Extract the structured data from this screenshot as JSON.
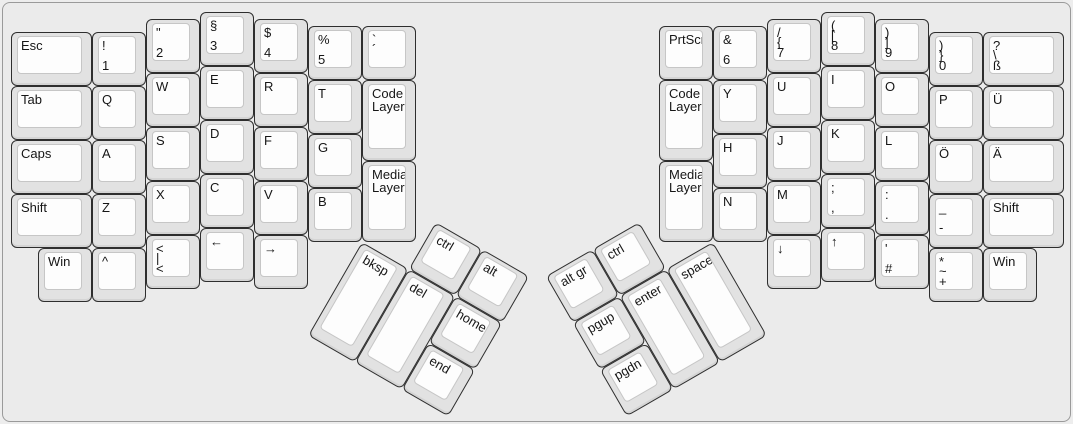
{
  "app": {
    "background_color": "#ebebeb",
    "panel_border_color": "#9a9a9a",
    "key_cap_color": "#e2e2e2",
    "key_top_color": "#fdfdfd",
    "key_border_color": "#2e2e2e",
    "label_color": "#161616"
  },
  "keyboard": {
    "unit": 54,
    "sections": [
      {
        "name": "left-main",
        "origin": [
          10,
          11
        ],
        "rotation": 0,
        "keys": [
          {
            "name": "key-esc",
            "x": 0,
            "y": 0.375,
            "w": 1.5,
            "h": 1,
            "labels": [
              "Esc",
              "",
              ""
            ]
          },
          {
            "name": "key-1",
            "x": 1.5,
            "y": 0.375,
            "w": 1,
            "h": 1,
            "labels": [
              "!",
              "",
              "1"
            ]
          },
          {
            "name": "key-2",
            "x": 2.5,
            "y": 0.125,
            "w": 1,
            "h": 1,
            "labels": [
              "\"",
              "",
              "2"
            ]
          },
          {
            "name": "key-3",
            "x": 3.5,
            "y": 0,
            "w": 1,
            "h": 1,
            "labels": [
              "§",
              "",
              "3"
            ]
          },
          {
            "name": "key-4",
            "x": 4.5,
            "y": 0.125,
            "w": 1,
            "h": 1,
            "labels": [
              "$",
              "",
              "4"
            ]
          },
          {
            "name": "key-5",
            "x": 5.5,
            "y": 0.25,
            "w": 1,
            "h": 1,
            "labels": [
              "%",
              "",
              "5"
            ]
          },
          {
            "name": "key-acute",
            "x": 6.5,
            "y": 0.25,
            "w": 1,
            "h": 1,
            "labels": [
              "`",
              "´",
              ""
            ]
          },
          {
            "name": "key-tab",
            "x": 0,
            "y": 1.375,
            "w": 1.5,
            "h": 1,
            "labels": [
              "Tab",
              "",
              ""
            ]
          },
          {
            "name": "key-q",
            "x": 1.5,
            "y": 1.375,
            "w": 1,
            "h": 1,
            "labels": [
              "Q",
              "",
              ""
            ]
          },
          {
            "name": "key-w",
            "x": 2.5,
            "y": 1.125,
            "w": 1,
            "h": 1,
            "labels": [
              "W",
              "",
              ""
            ]
          },
          {
            "name": "key-e",
            "x": 3.5,
            "y": 1,
            "w": 1,
            "h": 1,
            "labels": [
              "E",
              "",
              ""
            ]
          },
          {
            "name": "key-r",
            "x": 4.5,
            "y": 1.125,
            "w": 1,
            "h": 1,
            "labels": [
              "R",
              "",
              ""
            ]
          },
          {
            "name": "key-t",
            "x": 5.5,
            "y": 1.25,
            "w": 1,
            "h": 1,
            "labels": [
              "T",
              "",
              ""
            ]
          },
          {
            "name": "key-code-layer-left",
            "x": 6.5,
            "y": 1.25,
            "w": 1,
            "h": 1.5,
            "labels": [
              "Code Layer",
              "",
              ""
            ]
          },
          {
            "name": "key-caps",
            "x": 0,
            "y": 2.375,
            "w": 1.5,
            "h": 1,
            "labels": [
              "Caps",
              "",
              ""
            ]
          },
          {
            "name": "key-a",
            "x": 1.5,
            "y": 2.375,
            "w": 1,
            "h": 1,
            "labels": [
              "A",
              "",
              ""
            ]
          },
          {
            "name": "key-s",
            "x": 2.5,
            "y": 2.125,
            "w": 1,
            "h": 1,
            "labels": [
              "S",
              "",
              ""
            ]
          },
          {
            "name": "key-d",
            "x": 3.5,
            "y": 2,
            "w": 1,
            "h": 1,
            "labels": [
              "D",
              "",
              ""
            ]
          },
          {
            "name": "key-f",
            "x": 4.5,
            "y": 2.125,
            "w": 1,
            "h": 1,
            "labels": [
              "F",
              "",
              ""
            ]
          },
          {
            "name": "key-g",
            "x": 5.5,
            "y": 2.25,
            "w": 1,
            "h": 1,
            "labels": [
              "G",
              "",
              ""
            ]
          },
          {
            "name": "key-media-layer-left",
            "x": 6.5,
            "y": 2.75,
            "w": 1,
            "h": 1.5,
            "labels": [
              "Media Layer",
              "",
              ""
            ]
          },
          {
            "name": "key-shift-left",
            "x": 0,
            "y": 3.375,
            "w": 1.5,
            "h": 1,
            "labels": [
              "Shift",
              "",
              ""
            ]
          },
          {
            "name": "key-z",
            "x": 1.5,
            "y": 3.375,
            "w": 1,
            "h": 1,
            "labels": [
              "Z",
              "",
              ""
            ]
          },
          {
            "name": "key-x",
            "x": 2.5,
            "y": 3.125,
            "w": 1,
            "h": 1,
            "labels": [
              "X",
              "",
              ""
            ]
          },
          {
            "name": "key-c",
            "x": 3.5,
            "y": 3,
            "w": 1,
            "h": 1,
            "labels": [
              "C",
              "",
              ""
            ]
          },
          {
            "name": "key-v",
            "x": 4.5,
            "y": 3.125,
            "w": 1,
            "h": 1,
            "labels": [
              "V",
              "",
              ""
            ]
          },
          {
            "name": "key-b",
            "x": 5.5,
            "y": 3.25,
            "w": 1,
            "h": 1,
            "labels": [
              "B",
              "",
              ""
            ]
          },
          {
            "name": "key-win-left",
            "x": 0.5,
            "y": 4.375,
            "w": 1,
            "h": 1,
            "labels": [
              "Win",
              "",
              ""
            ]
          },
          {
            "name": "key-caret",
            "x": 1.5,
            "y": 4.375,
            "w": 1,
            "h": 1,
            "labels": [
              "^",
              "",
              ""
            ]
          },
          {
            "name": "key-less-than",
            "x": 2.5,
            "y": 4.125,
            "w": 1,
            "h": 1,
            "labels": [
              "<",
              "|",
              "<"
            ]
          },
          {
            "name": "key-arrow-left",
            "x": 3.5,
            "y": 4,
            "w": 1,
            "h": 1,
            "labels": [
              "←",
              "",
              ""
            ]
          },
          {
            "name": "key-arrow-right",
            "x": 4.5,
            "y": 4.125,
            "w": 1,
            "h": 1,
            "labels": [
              "→",
              "",
              ""
            ]
          }
        ]
      },
      {
        "name": "right-main",
        "origin": [
          658,
          11
        ],
        "rotation": 0,
        "keys": [
          {
            "name": "key-prtscr",
            "x": 0,
            "y": 0.25,
            "w": 1,
            "h": 1,
            "labels": [
              "PrtScr",
              "",
              ""
            ]
          },
          {
            "name": "key-6",
            "x": 1,
            "y": 0.25,
            "w": 1,
            "h": 1,
            "labels": [
              "&",
              "",
              "6"
            ]
          },
          {
            "name": "key-7",
            "x": 2,
            "y": 0.125,
            "w": 1,
            "h": 1,
            "labels": [
              "/",
              "{",
              "7"
            ]
          },
          {
            "name": "key-8",
            "x": 3,
            "y": 0,
            "w": 1,
            "h": 1,
            "labels": [
              "(",
              "[",
              "8"
            ]
          },
          {
            "name": "key-9",
            "x": 4,
            "y": 0.125,
            "w": 1,
            "h": 1,
            "labels": [
              ")",
              "]",
              "9"
            ]
          },
          {
            "name": "key-0",
            "x": 5,
            "y": 0.375,
            "w": 1,
            "h": 1,
            "labels": [
              ")",
              "}",
              "0"
            ]
          },
          {
            "name": "key-eszett",
            "x": 6,
            "y": 0.375,
            "w": 1.5,
            "h": 1,
            "labels": [
              "?",
              "\\",
              "ß"
            ]
          },
          {
            "name": "key-code-layer-right",
            "x": 0,
            "y": 1.25,
            "w": 1,
            "h": 1.5,
            "labels": [
              "Code Layer",
              "",
              ""
            ]
          },
          {
            "name": "key-y",
            "x": 1,
            "y": 1.25,
            "w": 1,
            "h": 1,
            "labels": [
              "Y",
              "",
              ""
            ]
          },
          {
            "name": "key-u",
            "x": 2,
            "y": 1.125,
            "w": 1,
            "h": 1,
            "labels": [
              "U",
              "",
              ""
            ]
          },
          {
            "name": "key-i",
            "x": 3,
            "y": 1,
            "w": 1,
            "h": 1,
            "labels": [
              "I",
              "",
              ""
            ]
          },
          {
            "name": "key-o",
            "x": 4,
            "y": 1.125,
            "w": 1,
            "h": 1,
            "labels": [
              "O",
              "",
              ""
            ]
          },
          {
            "name": "key-p",
            "x": 5,
            "y": 1.375,
            "w": 1,
            "h": 1,
            "labels": [
              "P",
              "",
              ""
            ]
          },
          {
            "name": "key-u-umlaut",
            "x": 6,
            "y": 1.375,
            "w": 1.5,
            "h": 1,
            "labels": [
              "Ü",
              "",
              ""
            ]
          },
          {
            "name": "key-media-layer-right",
            "x": 0,
            "y": 2.75,
            "w": 1,
            "h": 1.5,
            "labels": [
              "Media Layer",
              "",
              ""
            ]
          },
          {
            "name": "key-h",
            "x": 1,
            "y": 2.25,
            "w": 1,
            "h": 1,
            "labels": [
              "H",
              "",
              ""
            ]
          },
          {
            "name": "key-j",
            "x": 2,
            "y": 2.125,
            "w": 1,
            "h": 1,
            "labels": [
              "J",
              "",
              ""
            ]
          },
          {
            "name": "key-k",
            "x": 3,
            "y": 2,
            "w": 1,
            "h": 1,
            "labels": [
              "K",
              "",
              ""
            ]
          },
          {
            "name": "key-l",
            "x": 4,
            "y": 2.125,
            "w": 1,
            "h": 1,
            "labels": [
              "L",
              "",
              ""
            ]
          },
          {
            "name": "key-o-umlaut",
            "x": 5,
            "y": 2.375,
            "w": 1,
            "h": 1,
            "labels": [
              "Ö",
              "",
              ""
            ]
          },
          {
            "name": "key-a-umlaut",
            "x": 6,
            "y": 2.375,
            "w": 1.5,
            "h": 1,
            "labels": [
              "Ä",
              "",
              ""
            ]
          },
          {
            "name": "key-n",
            "x": 1,
            "y": 3.25,
            "w": 1,
            "h": 1,
            "labels": [
              "N",
              "",
              ""
            ]
          },
          {
            "name": "key-m",
            "x": 2,
            "y": 3.125,
            "w": 1,
            "h": 1,
            "labels": [
              "M",
              "",
              ""
            ]
          },
          {
            "name": "key-semicolon",
            "x": 3,
            "y": 3,
            "w": 1,
            "h": 1,
            "labels": [
              ";",
              "",
              ","
            ]
          },
          {
            "name": "key-colon",
            "x": 4,
            "y": 3.125,
            "w": 1,
            "h": 1,
            "labels": [
              ":",
              "",
              "."
            ]
          },
          {
            "name": "key-underscore",
            "x": 5,
            "y": 3.375,
            "w": 1,
            "h": 1,
            "labels": [
              "_",
              "",
              "-"
            ]
          },
          {
            "name": "key-shift-right",
            "x": 6,
            "y": 3.375,
            "w": 1.5,
            "h": 1,
            "labels": [
              "Shift",
              "",
              ""
            ]
          },
          {
            "name": "key-arrow-down",
            "x": 2,
            "y": 4.125,
            "w": 1,
            "h": 1,
            "labels": [
              "↓",
              "",
              ""
            ]
          },
          {
            "name": "key-arrow-up",
            "x": 3,
            "y": 4,
            "w": 1,
            "h": 1,
            "labels": [
              "↑",
              "",
              ""
            ]
          },
          {
            "name": "key-hash",
            "x": 4,
            "y": 4.125,
            "w": 1,
            "h": 1,
            "labels": [
              "'",
              "",
              "#"
            ]
          },
          {
            "name": "key-plus",
            "x": 5,
            "y": 4.375,
            "w": 1,
            "h": 1,
            "labels": [
              "*",
              "~",
              "+"
            ]
          },
          {
            "name": "key-win-right",
            "x": 6,
            "y": 4.375,
            "w": 1,
            "h": 1,
            "labels": [
              "Win",
              "",
              ""
            ]
          }
        ]
      },
      {
        "name": "left-thumb",
        "origin": [
          361,
          240.5
        ],
        "rotation": 30,
        "keys": [
          {
            "name": "key-ctrl-left",
            "x": 1,
            "y": -1,
            "w": 1,
            "h": 1,
            "labels": [
              "ctrl",
              "",
              ""
            ]
          },
          {
            "name": "key-alt",
            "x": 2,
            "y": -1,
            "w": 1,
            "h": 1,
            "labels": [
              "alt",
              "",
              ""
            ]
          },
          {
            "name": "key-bksp",
            "x": 0,
            "y": 0,
            "w": 1,
            "h": 2,
            "labels": [
              "bksp",
              "",
              ""
            ]
          },
          {
            "name": "key-del",
            "x": 1,
            "y": 0,
            "w": 1,
            "h": 2,
            "labels": [
              "del",
              "",
              ""
            ]
          },
          {
            "name": "key-home",
            "x": 2,
            "y": 0,
            "w": 1,
            "h": 1,
            "labels": [
              "home",
              "",
              ""
            ]
          },
          {
            "name": "key-end",
            "x": 2,
            "y": 1,
            "w": 1,
            "h": 1,
            "labels": [
              "end",
              "",
              ""
            ]
          }
        ]
      },
      {
        "name": "right-thumb",
        "origin": [
          712,
          240.5
        ],
        "rotation": -30,
        "keys": [
          {
            "name": "key-altgr",
            "x": -3,
            "y": -1,
            "w": 1,
            "h": 1,
            "labels": [
              "alt gr",
              "",
              ""
            ]
          },
          {
            "name": "key-ctrl-right",
            "x": -2,
            "y": -1,
            "w": 1,
            "h": 1,
            "labels": [
              "ctrl",
              "",
              ""
            ]
          },
          {
            "name": "key-pgup",
            "x": -3,
            "y": 0,
            "w": 1,
            "h": 1,
            "labels": [
              "pgup",
              "",
              ""
            ]
          },
          {
            "name": "key-enter",
            "x": -2,
            "y": 0,
            "w": 1,
            "h": 2,
            "labels": [
              "enter",
              "",
              ""
            ]
          },
          {
            "name": "key-space",
            "x": -1,
            "y": 0,
            "w": 1,
            "h": 2,
            "labels": [
              "space",
              "",
              ""
            ]
          },
          {
            "name": "key-pgdn",
            "x": -3,
            "y": 1,
            "w": 1,
            "h": 1,
            "labels": [
              "pgdn",
              "",
              ""
            ]
          }
        ]
      }
    ]
  }
}
